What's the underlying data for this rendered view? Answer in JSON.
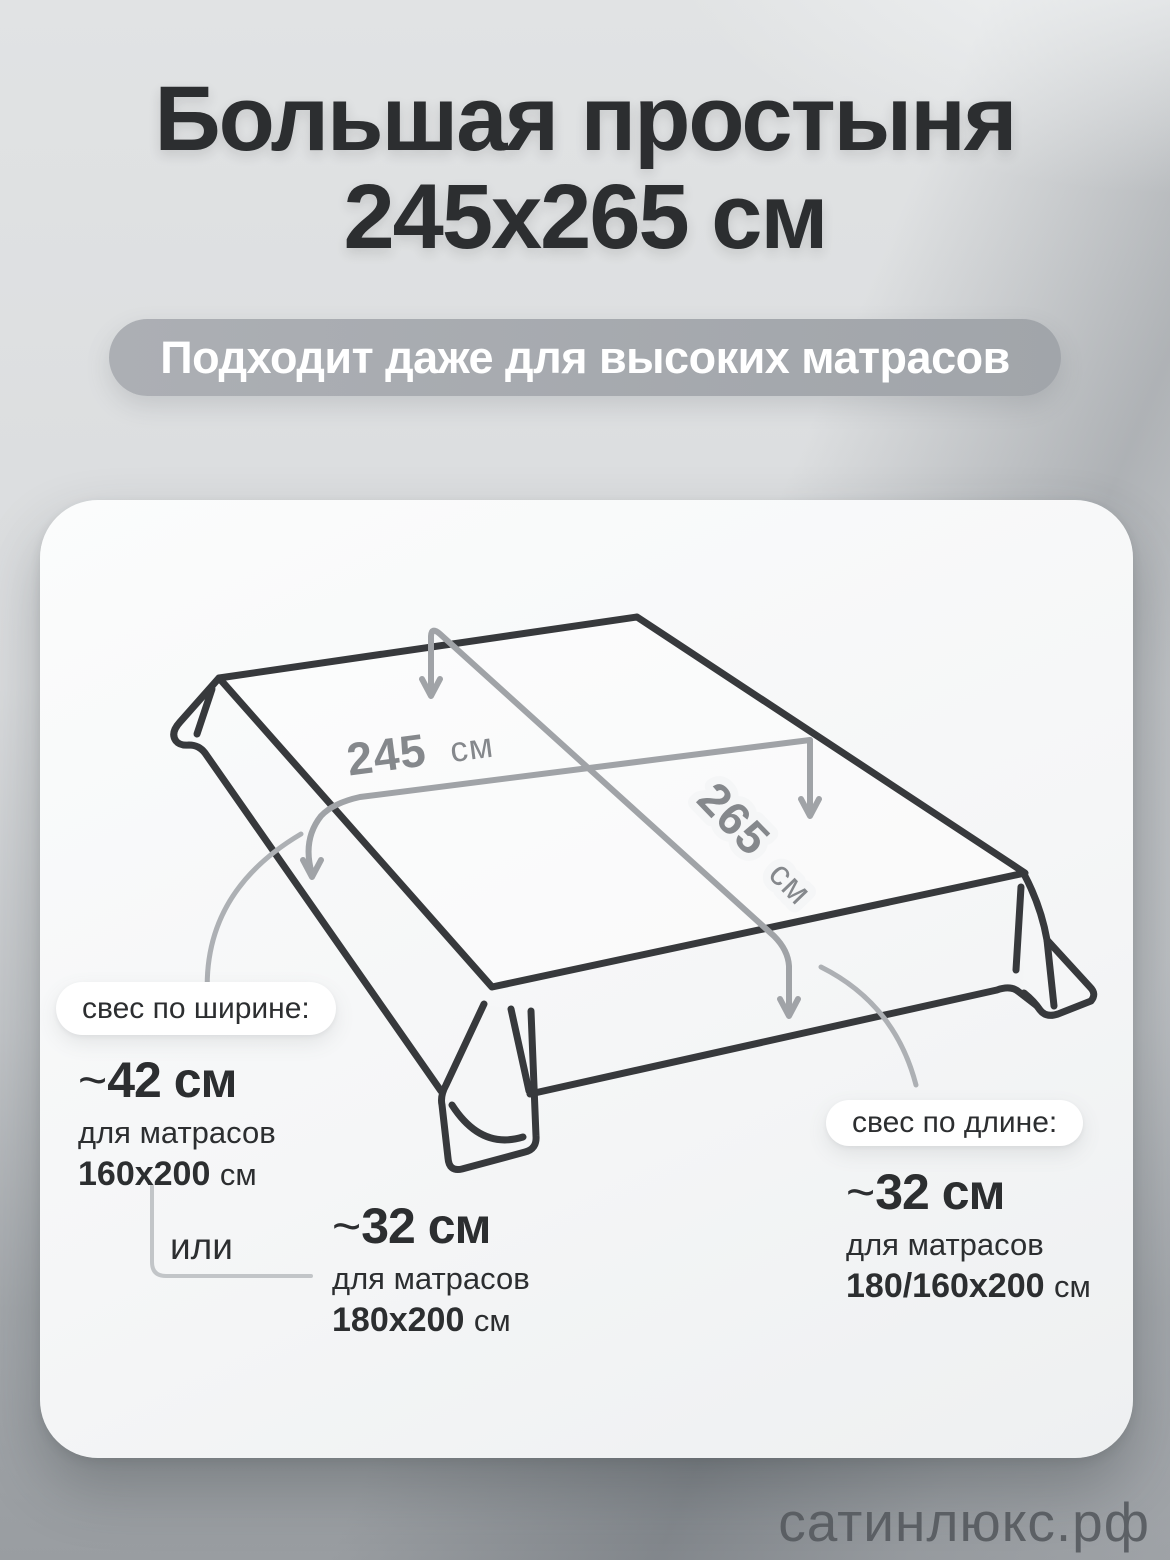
{
  "title": {
    "line1": "Большая простыня",
    "line2": "245х265 см"
  },
  "badge": {
    "text": "Подходит даже для высоких матрасов"
  },
  "diagram": {
    "width_dim": {
      "value": "245",
      "unit": "см"
    },
    "length_dim": {
      "value": "265",
      "unit": "см"
    }
  },
  "callouts": {
    "width": {
      "pill": "свес по ширине:",
      "approx": "~",
      "value": "42 см",
      "for_line": "для матрасов",
      "size": "160х200",
      "size_unit": "см"
    },
    "or": "или",
    "width_alt": {
      "approx": "~",
      "value": "32 см",
      "for_line": "для матрасов",
      "size": "180х200",
      "size_unit": "см"
    },
    "length": {
      "pill": "свес по длине:",
      "approx": "~",
      "value": "32 см",
      "for_line": "для матрасов",
      "size": "180/160х200",
      "size_unit": "см"
    }
  },
  "watermark": "сатинлюкс.рф",
  "colors": {
    "ink": "#2c2e30",
    "pill_gray": "#a6a9ae",
    "dim_line": "#a0a3a7",
    "sheet_line": "#37393c",
    "card_bg": "#f5f6f7",
    "watermark_gray": "#575b60"
  }
}
